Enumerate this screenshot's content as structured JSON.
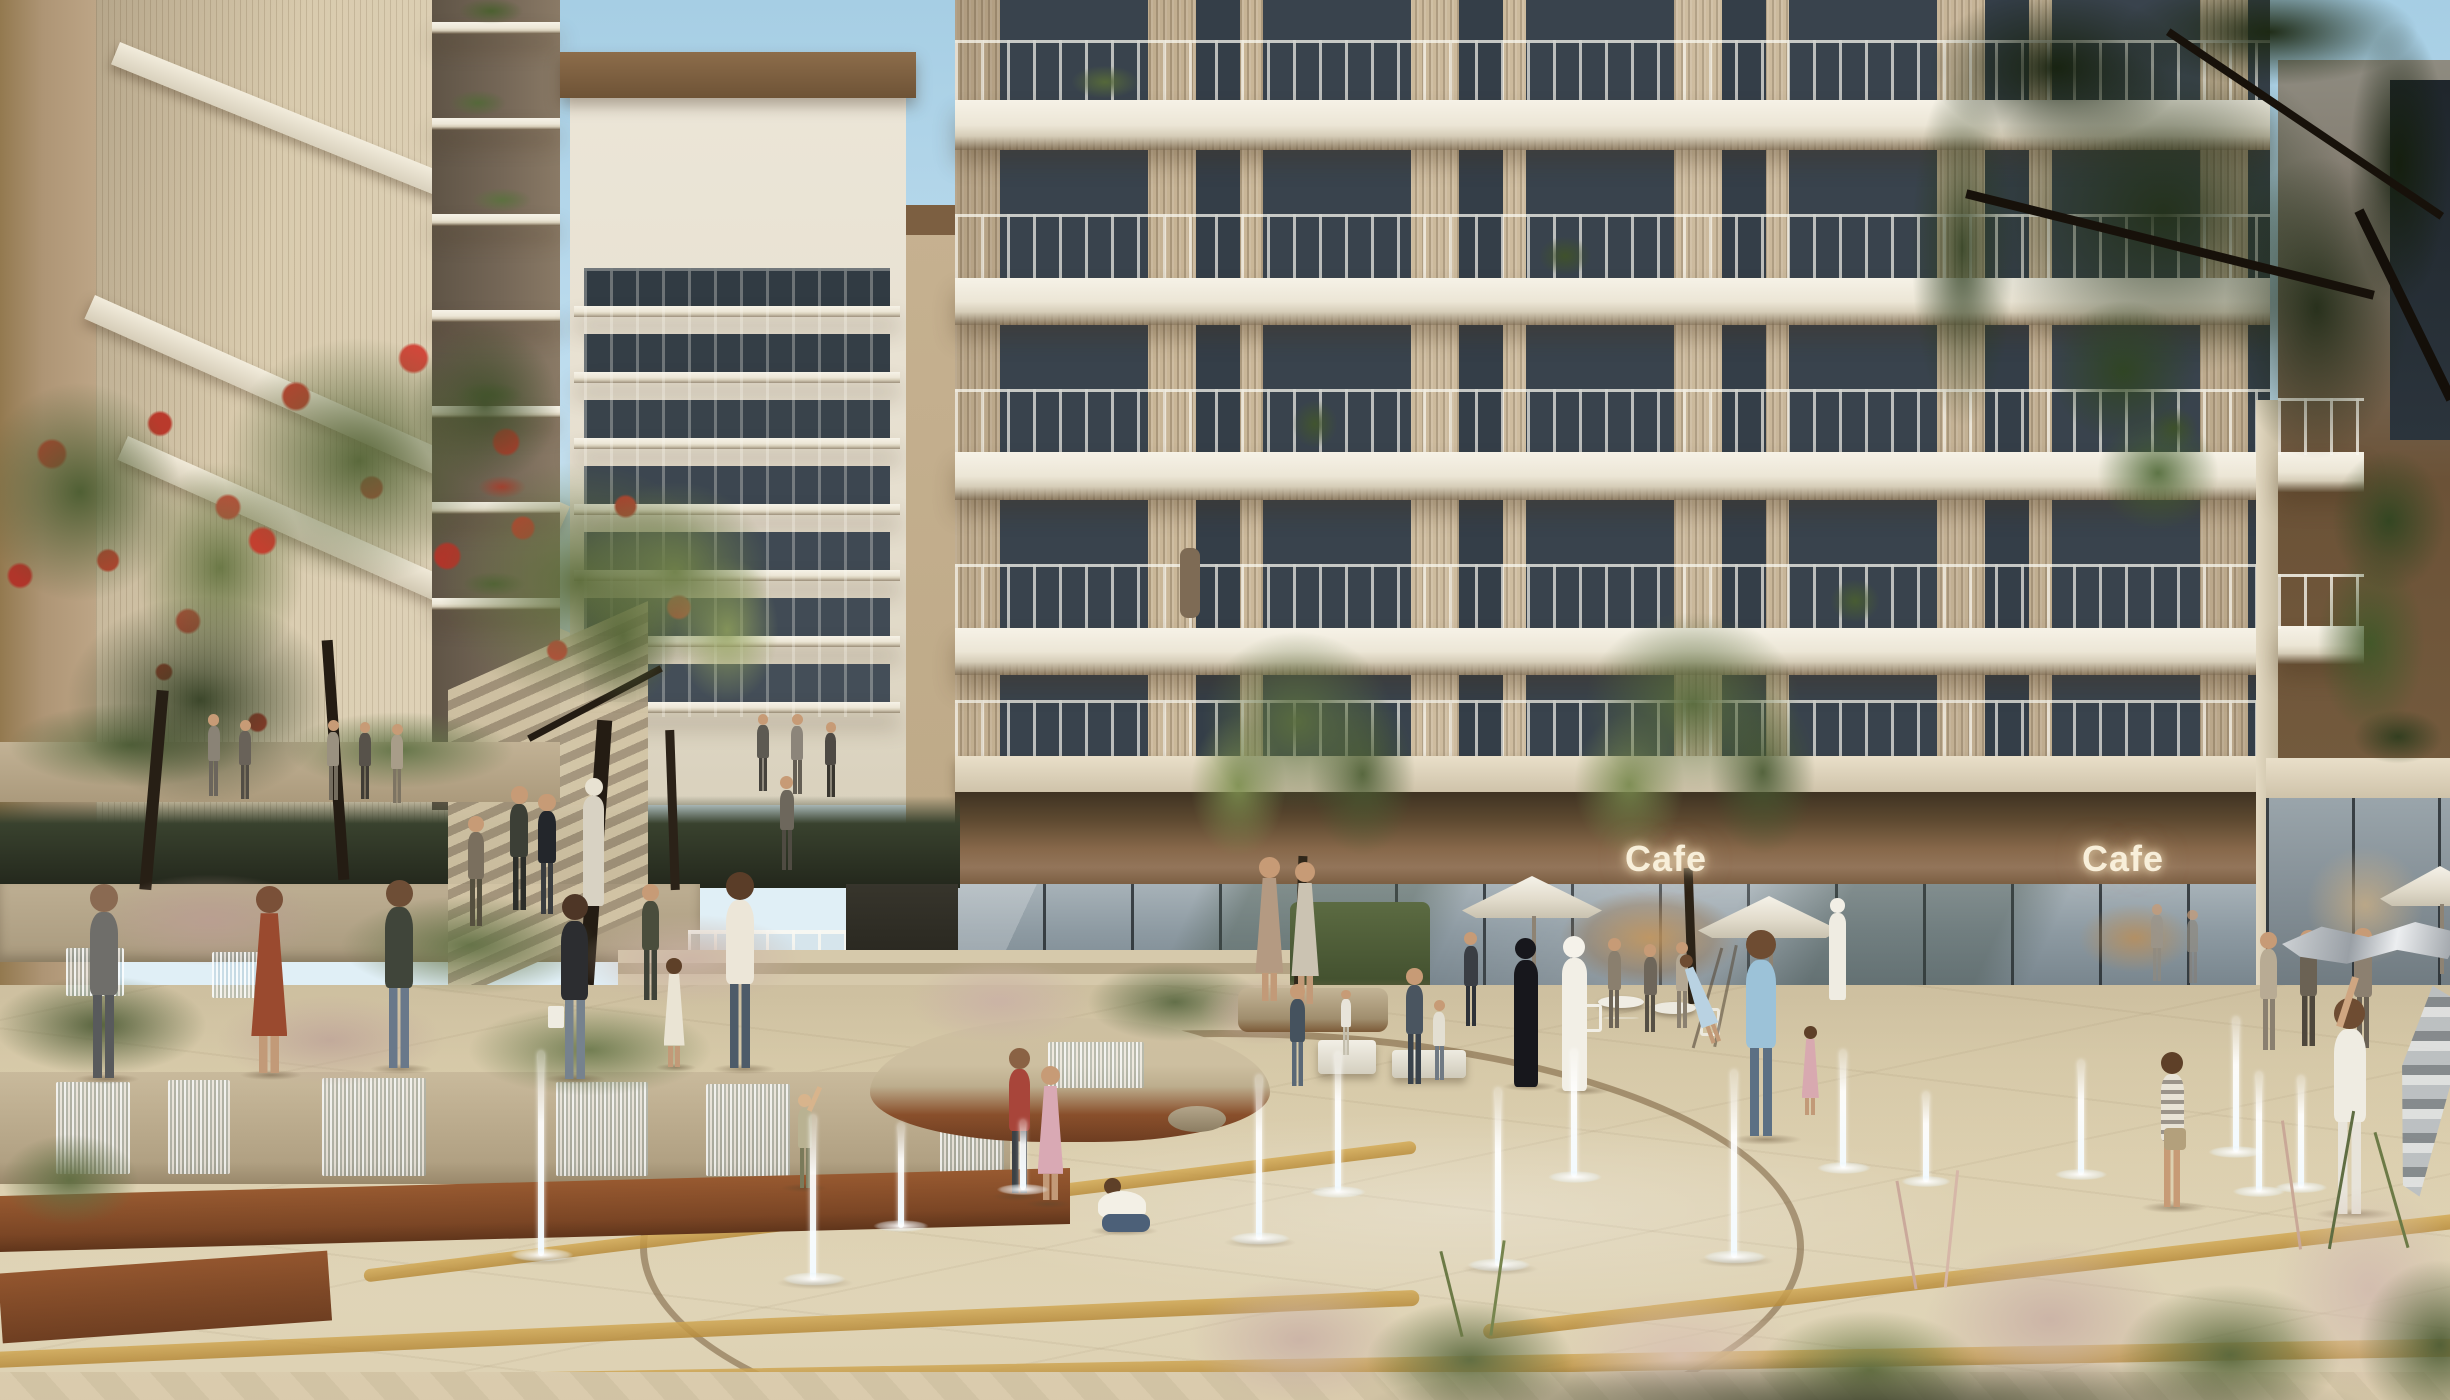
{
  "scene": {
    "description": "Sunlit architectural rendering of a residential community plaza with splash-pad fountains, terraced gardens, flowering trees and ground-floor cafes beneath modern slatted apartment buildings",
    "style": "photorealistic CGI visualization",
    "time_of_day": "midday"
  },
  "signs": {
    "cafe_left": "Cafe",
    "cafe_right": "Cafe"
  },
  "palette": {
    "sky": "#b3d7ea",
    "facade_slats": "#c9b697",
    "balcony_slab": "#f0ece0",
    "window_glass": "#39434d",
    "bronze_fascia": "#7a5c3a",
    "storefront_glass": "#93a0a8",
    "paving": "#ded2b4",
    "paving_gold_inlay": "#c59c44",
    "corten_steel": "#8a4f2b",
    "foliage_green": "#5d7042",
    "foliage_dark": "#1d2a14",
    "red_flowers": "#c23b2e",
    "ornamental_grass_pink": "#cbb3a6",
    "water_jet": "#eef6fa"
  },
  "elements": {
    "buildings": [
      "left slatted tower with planted balcony edge and diagonal walkway bands",
      "background mid-rise with stacked white balconies and bronze cornice",
      "main apartment block with timber-slat facade, dark glazing and white cantilevered balconies",
      "right block behind dark tree canopy with retail glazing"
    ],
    "cafes": {
      "count": 2,
      "labels": [
        "Cafe",
        "Cafe"
      ],
      "features": [
        "illuminated channel-letter signs",
        "glass storefronts",
        "white patio umbrellas",
        "outdoor tables and chairs"
      ]
    },
    "fountains": {
      "splash_jets": 15,
      "cascade_wall_sections": 8,
      "round_planter_fountain": 1
    },
    "people": {
      "approx_count": 40,
      "groups": [
        "children playing in the splash fountains",
        "couple in traditional Emirati dress (white kandura, black abaya)",
        "father swinging a child near the cafe",
        "cafe patrons under umbrellas",
        "shoppers and families on terraced garden steps",
        "boy running and child waving a silver streamer"
      ]
    },
    "landscape": [
      "red flowering trees",
      "ornamental grasses with pink plumes",
      "terraced stone planters",
      "corten steel edging",
      "golden paving inlay bands",
      "dark overhanging tree canopy top right"
    ]
  }
}
